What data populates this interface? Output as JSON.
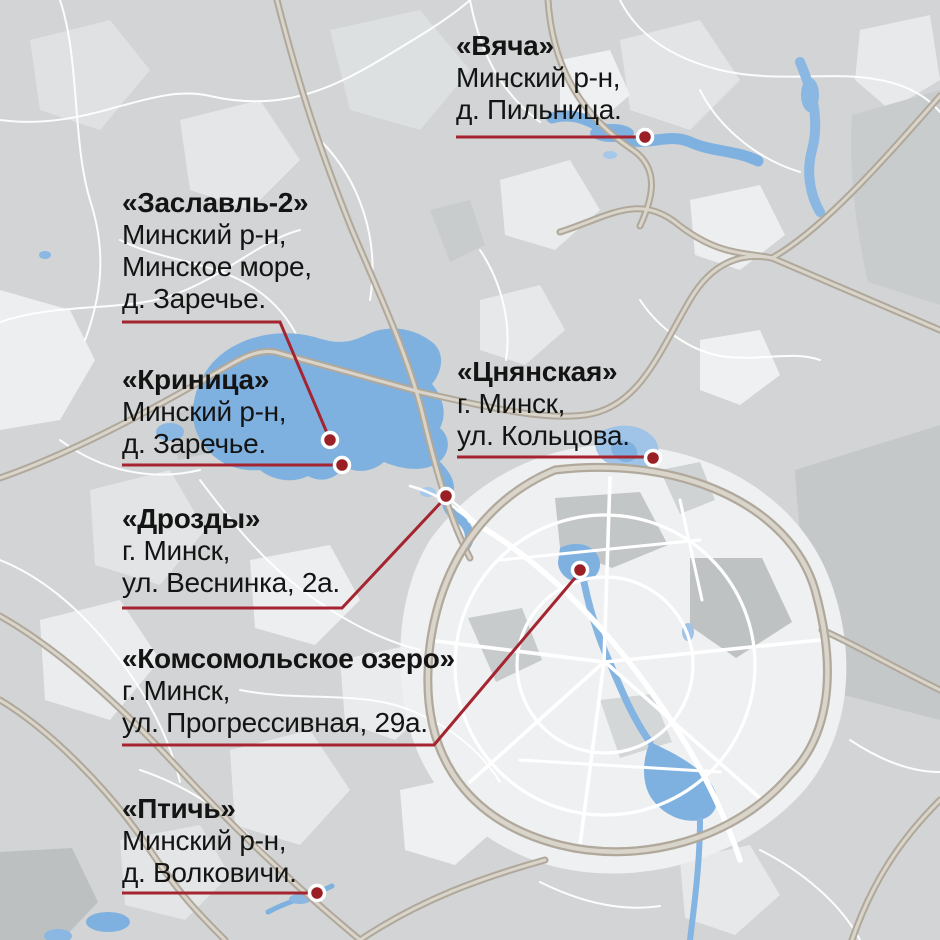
{
  "map": {
    "palette": {
      "base": "#d2d4d5",
      "field_light": "#e8eaeb",
      "field_lighter": "#f1f2f3",
      "forest_gray": "#c4c7c8",
      "city_fill": "#eef0f2",
      "water": "#7fb1e0",
      "water_pale": "#a6c9e9",
      "highway_casing": "#b0a89b",
      "highway_core": "#dad5ca",
      "street": "#ffffff",
      "leader_line": "#a42530",
      "marker_fill": "#9b2025",
      "marker_ring": "#ffffff",
      "label_text": "#141414"
    },
    "markers": [
      {
        "name": "«Вяча»",
        "address": [
          "Минский р-н,",
          "д. Пильница."
        ],
        "label": {
          "x": 456,
          "y": 30
        },
        "leader": [
          [
            456,
            137
          ],
          [
            645,
            137
          ]
        ],
        "dot": {
          "x": 645,
          "y": 137
        }
      },
      {
        "name": "«Заславль-2»",
        "address": [
          "Минский р-н,",
          "Минское море,",
          "д. Заречье."
        ],
        "label": {
          "x": 122,
          "y": 187
        },
        "leader": [
          [
            122,
            322
          ],
          [
            280,
            322
          ],
          [
            330,
            440
          ]
        ],
        "dot": {
          "x": 330,
          "y": 440
        }
      },
      {
        "name": "«Криница»",
        "address": [
          "Минский р-н,",
          "д. Заречье."
        ],
        "label": {
          "x": 122,
          "y": 364
        },
        "leader": [
          [
            122,
            465
          ],
          [
            342,
            465
          ]
        ],
        "dot": {
          "x": 342,
          "y": 465
        }
      },
      {
        "name": "«Цнянская»",
        "address": [
          "г. Минск,",
          "ул. Кольцова."
        ],
        "label": {
          "x": 457,
          "y": 356
        },
        "leader": [
          [
            457,
            457
          ],
          [
            653,
            457
          ]
        ],
        "dot": {
          "x": 653,
          "y": 458
        }
      },
      {
        "name": "«Дрозды»",
        "address": [
          "г. Минск,",
          "ул. Веснинка, 2а."
        ],
        "label": {
          "x": 122,
          "y": 503
        },
        "leader": [
          [
            122,
            608
          ],
          [
            342,
            608
          ],
          [
            446,
            497
          ]
        ],
        "dot": {
          "x": 446,
          "y": 496
        }
      },
      {
        "name": "«Комсомольское озеро»",
        "address": [
          "г. Минск,",
          "ул. Прогрессивная, 29а."
        ],
        "label": {
          "x": 122,
          "y": 643
        },
        "leader": [
          [
            122,
            745
          ],
          [
            434,
            745
          ],
          [
            580,
            572
          ]
        ],
        "dot": {
          "x": 580,
          "y": 570
        }
      },
      {
        "name": "«Птичь»",
        "address": [
          "Минский р-н,",
          "д. Волковичи."
        ],
        "label": {
          "x": 122,
          "y": 793
        },
        "leader": [
          [
            122,
            893
          ],
          [
            317,
            893
          ]
        ],
        "dot": {
          "x": 317,
          "y": 893
        }
      }
    ]
  }
}
